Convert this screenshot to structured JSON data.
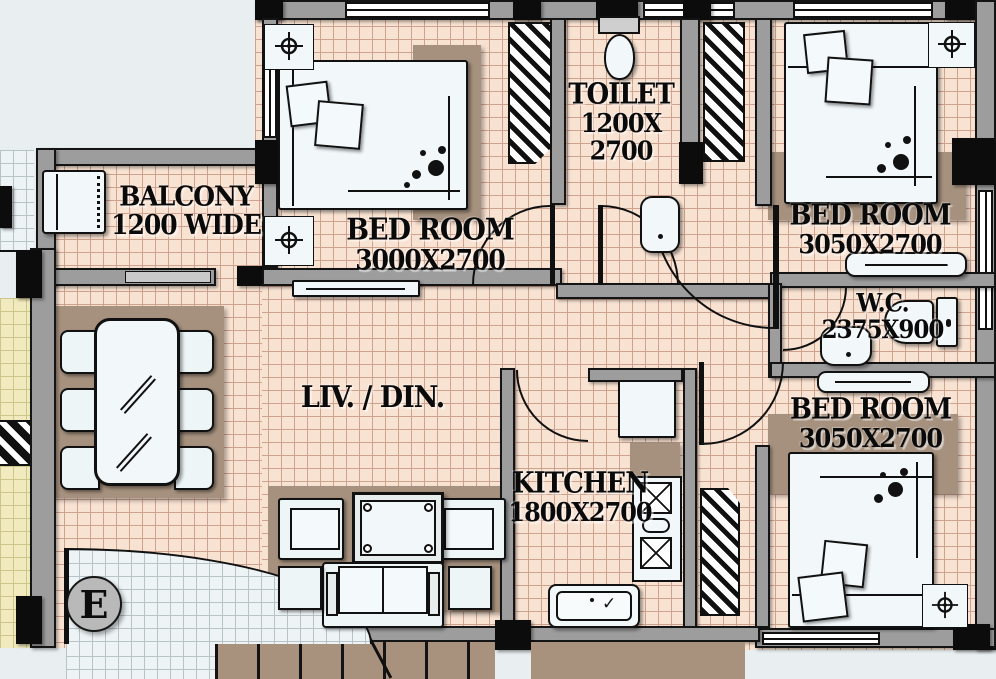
{
  "plan_type": "apartment-floor-plan",
  "rooms": {
    "balcony": {
      "name": "BALCONY",
      "size": "1200 WIDE"
    },
    "bedroom1": {
      "name": "BED ROOM",
      "size": "3000X2700"
    },
    "toilet": {
      "name": "TOILET",
      "size_line1": "1200X",
      "size_line2": "2700"
    },
    "bedroom2": {
      "name": "BED ROOM",
      "size": "3050X2700"
    },
    "wc": {
      "name": "W.C.",
      "size": "2375X900"
    },
    "living_dining": {
      "name": "LIV. / DIN."
    },
    "kitchen": {
      "name": "KITCHEN",
      "size": "1800X2700"
    },
    "bedroom3": {
      "name": "BED ROOM",
      "size": "3050X2700"
    }
  },
  "markers": {
    "entrance": "E"
  },
  "icons": {
    "ceiling_light": "crosshair-circle",
    "sink_drain": "check-mark"
  },
  "colors": {
    "floor_tile": "#f8e3d3",
    "tile_grid": "#cda28f",
    "white_tile": "#eef4f6",
    "yellow_tile": "#f1eabe",
    "rug": "#a6917e",
    "wall": "#9d9d9d",
    "outline": "#141414",
    "background": "#e9eff1",
    "fixture": "#f2f8fa"
  }
}
